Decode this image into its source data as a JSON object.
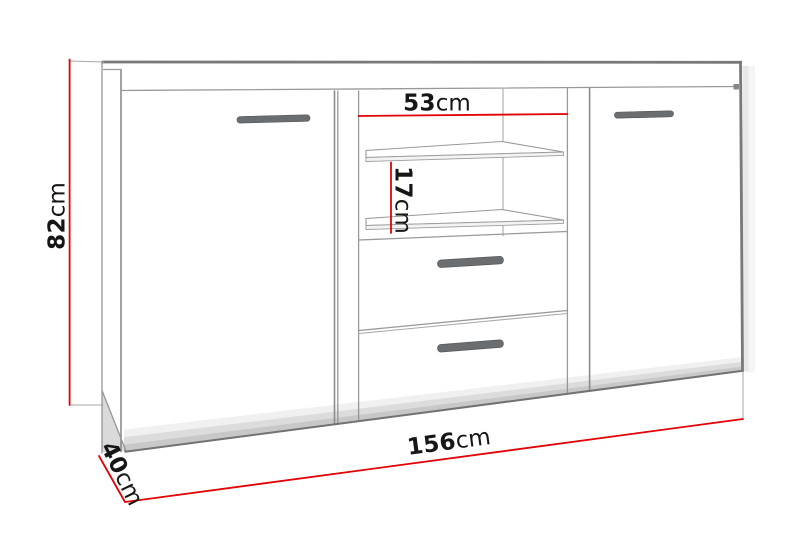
{
  "figure": {
    "kind": "furniture-dimension-diagram",
    "item": "sideboard"
  },
  "labels": {
    "height": {
      "value": "82",
      "unit": "cm"
    },
    "inner_width": {
      "value": "53",
      "unit": "cm"
    },
    "shelf_spacing": {
      "value": "17",
      "unit": "cm"
    },
    "width": {
      "value": "156",
      "unit": "cm"
    },
    "depth": {
      "value": "40",
      "unit": "cm"
    }
  },
  "colors": {
    "dimension_line": "#e10005",
    "outline": "#77797b",
    "line": "#97999b",
    "handle": "#6b6e71",
    "text": "#161616",
    "shadow": "#8c8c8c"
  }
}
